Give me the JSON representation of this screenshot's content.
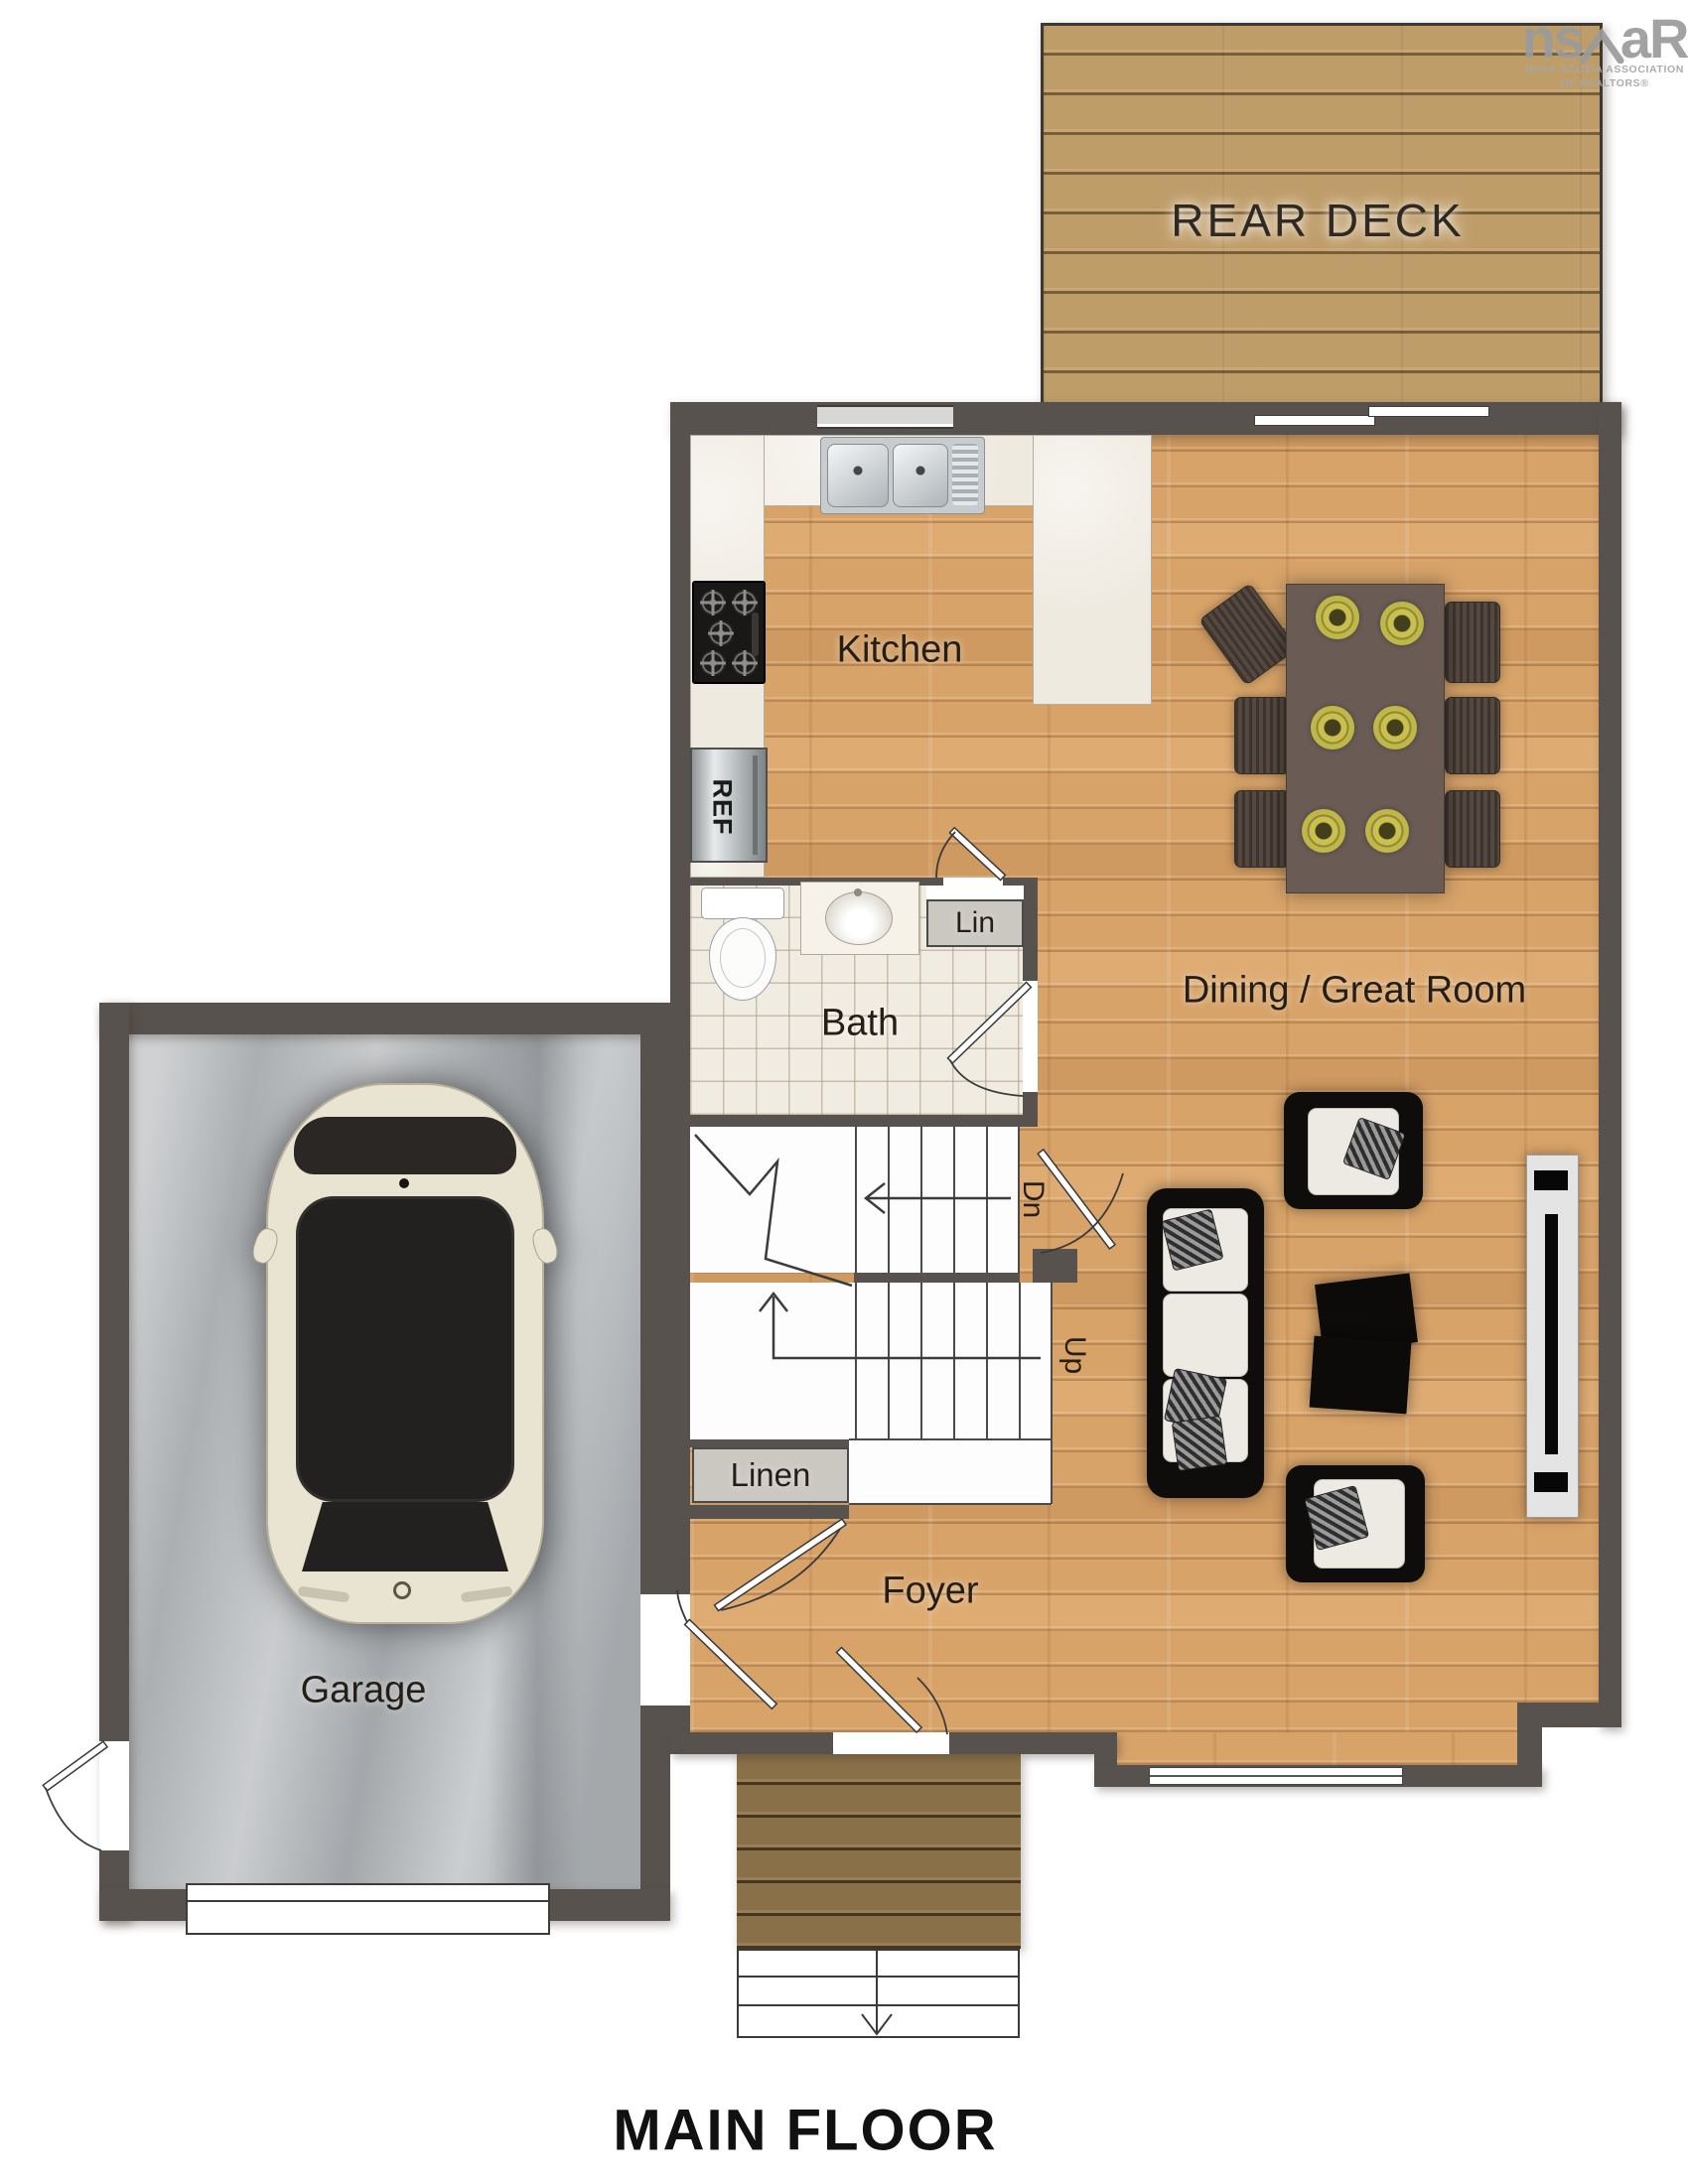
{
  "title": "MAIN FLOOR",
  "brand_logo": {
    "prefix": "ns",
    "suffix": "aR",
    "caption_top": "NOVA SCOTIA ASSOCIATION",
    "caption_bottom": "OF REALTORS®"
  },
  "rooms": {
    "rear_deck": "REAR DECK",
    "kitchen": "Kitchen",
    "dining_great_room": "Dining / Great Room",
    "bath": "Bath",
    "lin_closet": "Lin",
    "linen_closet": "Linen",
    "foyer": "Foyer",
    "garage": "Garage"
  },
  "labels": {
    "refrigerator": "REF",
    "stairs_down": "Dn",
    "stairs_up": "Up"
  },
  "colors": {
    "wall": "#57524d",
    "wood_floor": "#d7a369",
    "deck_wood": "#bf9d69",
    "porch_wood": "#8a7049",
    "counter": "#efeae0",
    "tile": "#f1ece2",
    "concrete": "#b6b9bc",
    "label_text": "#241e16",
    "logo_gray": "#9b9b9b",
    "plate_yellow": "#c9c050",
    "table_brown": "#6a5c55",
    "car_body": "#e9e3d2"
  }
}
